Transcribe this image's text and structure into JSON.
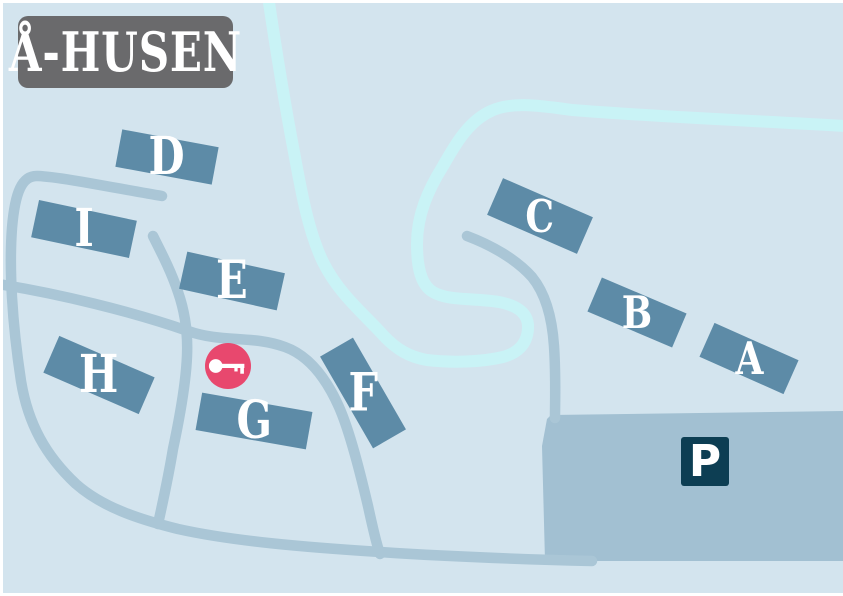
{
  "title": "Å-HUSEN",
  "buildings": [
    {
      "label": "A"
    },
    {
      "label": "B"
    },
    {
      "label": "C"
    },
    {
      "label": "D"
    },
    {
      "label": "E"
    },
    {
      "label": "F"
    },
    {
      "label": "G"
    },
    {
      "label": "H"
    },
    {
      "label": "I"
    }
  ],
  "parking": {
    "sign_label": "P"
  },
  "markers": {
    "key_marker_icon": "key-icon"
  },
  "features": {
    "river": "river",
    "roads": "roads",
    "parking_area": "parking-area"
  },
  "colors": {
    "background": "#d3e4ee",
    "building": "#5d8ba7",
    "road": "#aac6d6",
    "river": "#c9f3f6",
    "parking": "#a2c0d2",
    "parking_sign": "#0d3e53",
    "key_marker": "#e8486e",
    "title_box": "#6a6a6c",
    "label_text": "#ffffff"
  }
}
